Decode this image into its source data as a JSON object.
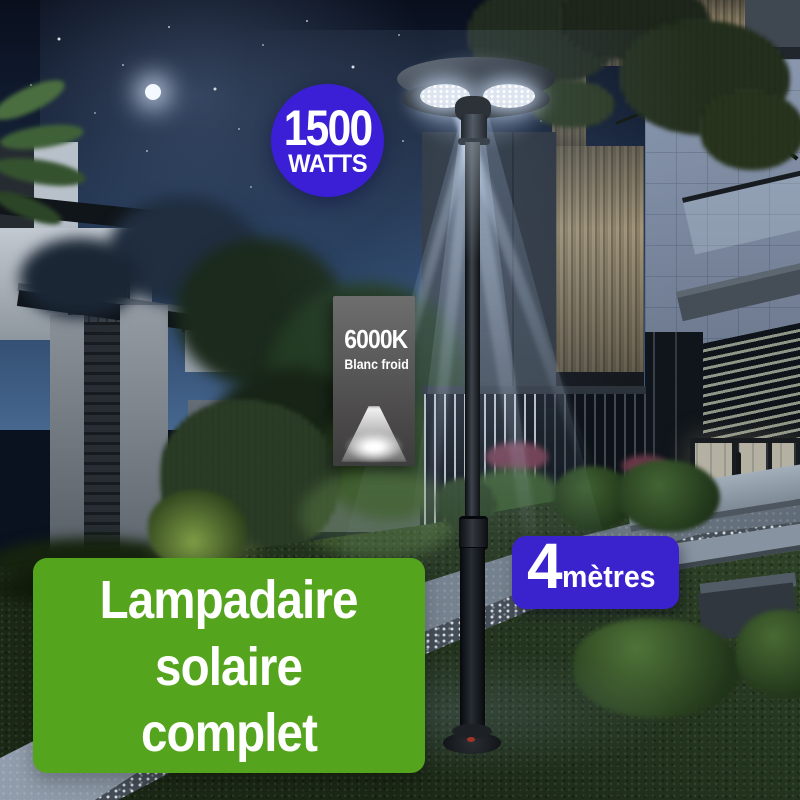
{
  "overlays": {
    "power_badge": {
      "value": "1500",
      "unit": "WATTS",
      "bg": "#3a1fd6",
      "fg": "#ffffff"
    },
    "color_temp_panel": {
      "value": "6000K",
      "label": "Blanc froid",
      "bg": "#5c5c5c",
      "fg": "#ffffff"
    },
    "height_badge": {
      "value": "4",
      "unit": "mètres",
      "bg": "#3a22cc",
      "fg": "#ffffff"
    },
    "title_badge": {
      "line1": "Lampadaire",
      "line2": "solaire",
      "line3": "complet",
      "bg": "#55a41e",
      "fg": "#ffffff"
    }
  }
}
